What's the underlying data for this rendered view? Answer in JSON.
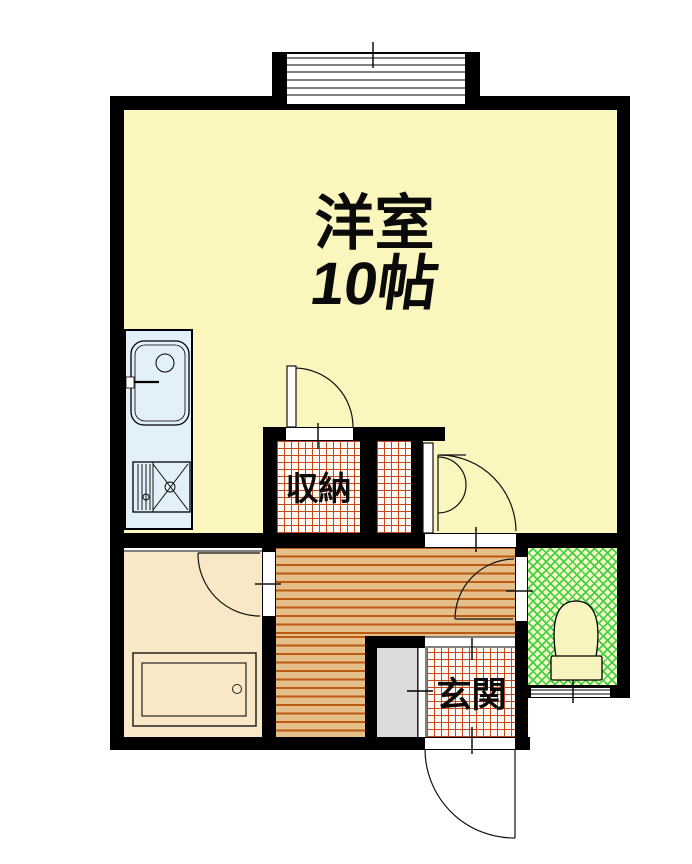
{
  "plan_title": "one-room apartment floor plan",
  "rooms": {
    "main": {
      "name": "洋室",
      "size": "10帖",
      "floor_color": "#FAF6BD"
    },
    "closet": {
      "name": "収納",
      "floor": "orange-grid-tile",
      "grid_color": "#C4481E",
      "base_color": "#FFFBF4"
    },
    "entrance": {
      "name": "玄関",
      "floor": "orange-grid-tile",
      "grid_color": "#C4481E",
      "base_color": "#FFFBF4"
    },
    "hallway": {
      "floor": "horizontal-stripe-wood",
      "base_color": "#E4BF8A",
      "stripe_color": "#BC5A14"
    },
    "bathroom": {
      "floor_color": "#F9E8C5"
    },
    "toilet_room": {
      "floor": "green-crosshatch",
      "base_color": "#F7F9C9",
      "hatch_color": "#44D044"
    }
  },
  "fixtures": {
    "kitchen_unit": "sink-faucet-and-stove",
    "bathtub": "bathtub-with-drain",
    "toilet": "toilet-bowl-with-tank",
    "shoe_cabinet": "gray-cabinet",
    "balcony_window": "sliding-window-top",
    "toilet_window": "small-window-bottom"
  },
  "doors": [
    "closet-hinged-door",
    "main-room-folding-door",
    "bathroom-hinged-door",
    "toilet-hinged-door",
    "entry-hinged-door"
  ],
  "colors": {
    "wall": "#000000",
    "background": "#FFFFFF",
    "kitchen_counter": "#E2F1F9",
    "cabinet_gray": "#DBDBDB"
  }
}
